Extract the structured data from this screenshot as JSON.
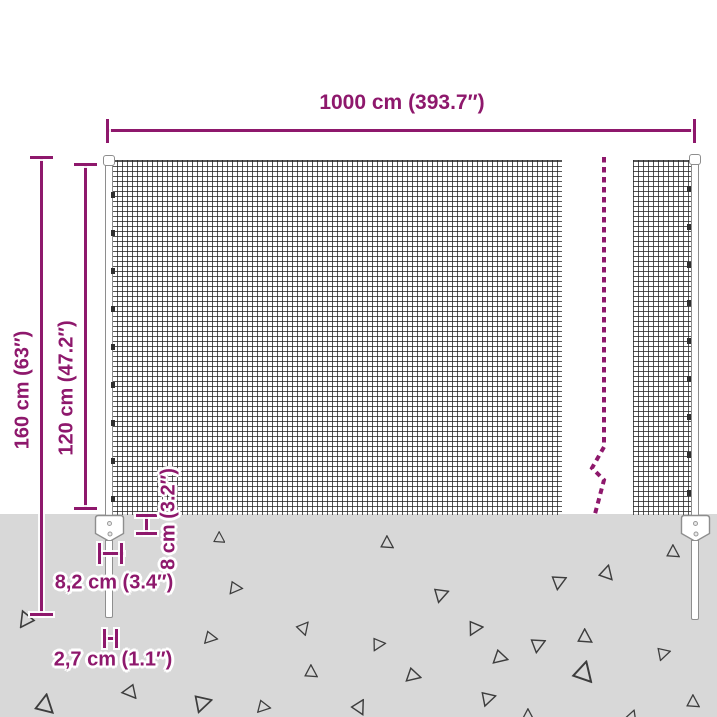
{
  "diagram": {
    "labels": {
      "width": "1000 cm (393.7″)",
      "total_height": "160 cm (63″)",
      "mesh_height": "120 cm (47.2″)",
      "anchor_height": "8 cm (3.2″)",
      "anchor_width": "8,2 cm (3.4″)",
      "spike_width": "2,7 cm (1.1″)"
    },
    "colors": {
      "accent": "#8E186C",
      "ground": "#D8D8D8",
      "wire": "#262626",
      "triangle_outline": "#3d3d3d"
    },
    "ground_triangles": [
      {
        "x": 219,
        "y": 537,
        "s": 8,
        "r": 0
      },
      {
        "x": 236,
        "y": 588,
        "s": 9,
        "r": 95
      },
      {
        "x": 304,
        "y": 627,
        "s": 9,
        "r": 40
      },
      {
        "x": 211,
        "y": 638,
        "s": 9,
        "r": 100
      },
      {
        "x": 311,
        "y": 671,
        "s": 9,
        "r": 0
      },
      {
        "x": 45,
        "y": 703,
        "s": 13,
        "r": 10
      },
      {
        "x": 131,
        "y": 693,
        "s": 10,
        "r": 140
      },
      {
        "x": 204,
        "y": 703,
        "s": 12,
        "r": 75
      },
      {
        "x": 264,
        "y": 707,
        "s": 9,
        "r": 100
      },
      {
        "x": 25,
        "y": 621,
        "s": 11,
        "r": 215
      },
      {
        "x": 387,
        "y": 542,
        "s": 9,
        "r": 0
      },
      {
        "x": 673,
        "y": 551,
        "s": 9,
        "r": 0
      },
      {
        "x": 607,
        "y": 572,
        "s": 10,
        "r": 15
      },
      {
        "x": 560,
        "y": 581,
        "s": 10,
        "r": 65
      },
      {
        "x": 442,
        "y": 594,
        "s": 10,
        "r": 70
      },
      {
        "x": 476,
        "y": 628,
        "s": 10,
        "r": 85
      },
      {
        "x": 585,
        "y": 636,
        "s": 10,
        "r": 0
      },
      {
        "x": 539,
        "y": 644,
        "s": 10,
        "r": 65
      },
      {
        "x": 379,
        "y": 644,
        "s": 9,
        "r": 85
      },
      {
        "x": 501,
        "y": 658,
        "s": 10,
        "r": 105
      },
      {
        "x": 664,
        "y": 653,
        "s": 9,
        "r": 75
      },
      {
        "x": 584,
        "y": 671,
        "s": 14,
        "r": 15
      },
      {
        "x": 414,
        "y": 676,
        "s": 10,
        "r": 105
      },
      {
        "x": 489,
        "y": 698,
        "s": 10,
        "r": 75
      },
      {
        "x": 693,
        "y": 701,
        "s": 9,
        "r": 0
      },
      {
        "x": 360,
        "y": 706,
        "s": 10,
        "r": 30
      },
      {
        "x": 528,
        "y": 715,
        "s": 9,
        "r": 0
      },
      {
        "x": 632,
        "y": 716,
        "s": 9,
        "r": 20
      }
    ]
  }
}
